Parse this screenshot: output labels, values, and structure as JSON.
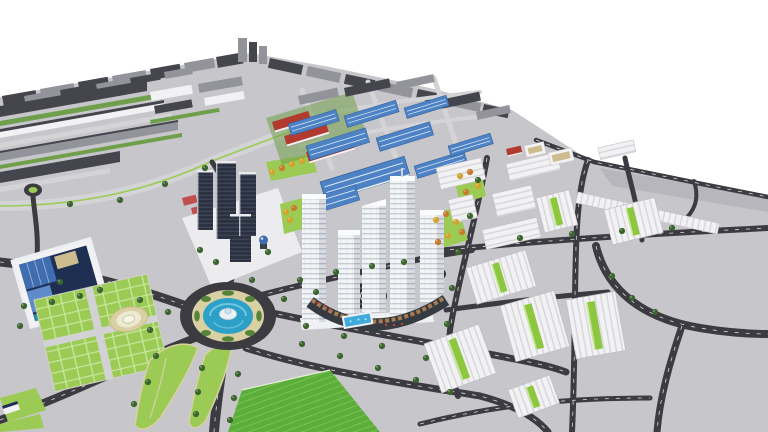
{
  "scene": {
    "kind": "3d-aerial-masterplan-render",
    "regions": [
      {
        "id": "northwest-district",
        "label": "dense mid-rise district"
      },
      {
        "id": "dark-tower-cluster",
        "label": "dark residential towers"
      },
      {
        "id": "industrial-halls",
        "label": "blue-roof commercial halls"
      },
      {
        "id": "school-blocks",
        "label": "red-roof campus blocks"
      },
      {
        "id": "central-tower-complex",
        "label": "white high-rise complex with podium and pool"
      },
      {
        "id": "fountain-roundabout",
        "label": "roundabout with water fountain"
      },
      {
        "id": "civic-blue-building",
        "label": "blue glass civic building"
      },
      {
        "id": "civic-plaza",
        "label": "lawn plaza with medallion"
      },
      {
        "id": "east-housing-district",
        "label": "white row-house clusters with green cores"
      },
      {
        "id": "leaf-park",
        "label": "leaf-shaped park lawns"
      },
      {
        "id": "south-lawn",
        "label": "bright green lawn"
      }
    ]
  },
  "palette": {
    "background": "#ffffff",
    "ground": "#c7c6cb",
    "ground_shade": "#b7b6bd",
    "road_dark": "#3b3b41",
    "road_light": "#d4d4d7",
    "road_marking": "#f4f4f4",
    "lawn_bright": "#5cae3c",
    "lawn_light": "#9ccb55",
    "park_green": "#6f9f4b",
    "hedge_green": "#55833a",
    "tree_dark": "#3a652e",
    "tree_yellow": "#d2a42c",
    "tree_orange": "#c77a2c",
    "water_blue": "#2da0c8",
    "water_light": "#7fd0e4",
    "plaza_beige": "#d9d0a4",
    "roof_dark": "#45454d",
    "wall_white": "#f2f2f4",
    "wall_shade": "#d9dbe0",
    "wall_gray": "#93939b",
    "tower_dark": "#2b3140",
    "glass_blue": "#3f6db0",
    "glass_navy": "#1e2f52",
    "glass_teal": "#2e8fa8",
    "glass_light": "#5f8cc8",
    "roof_blue": "#4d82c4",
    "roof_red": "#b23a2e",
    "beige_roof": "#cdbd8e",
    "podium_wood": "#a97c50",
    "pool_blue": "#41aadc",
    "window_line": "#b9c2cc",
    "plaza_white": "#ececee",
    "emblem_gold": "#c9a227"
  }
}
